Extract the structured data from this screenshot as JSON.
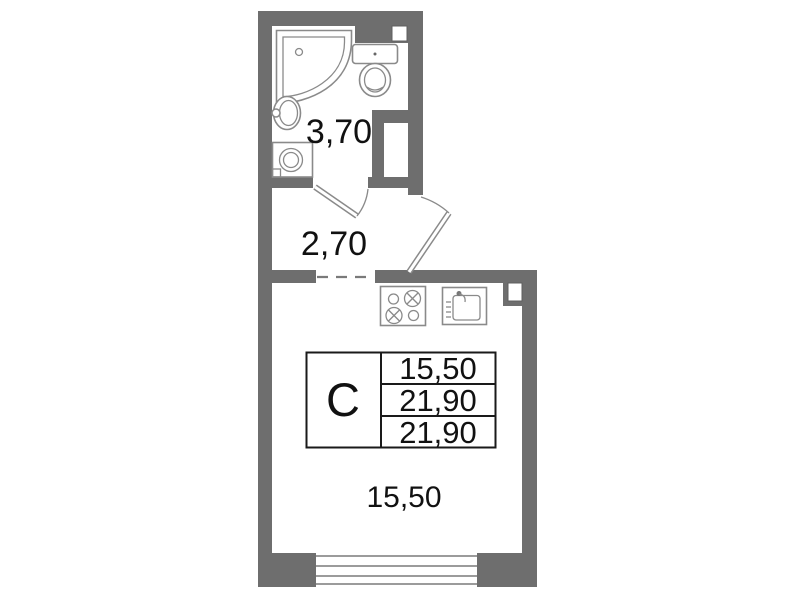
{
  "colors": {
    "wall": "#6e6e6e",
    "fixture_line": "#8a8a8a",
    "text": "#111111",
    "table_line": "#1a1a1a",
    "background": "#ffffff"
  },
  "rooms": {
    "bathroom": {
      "area_label": "3,70"
    },
    "hallway": {
      "area_label": "2,70"
    },
    "main_room": {
      "area_label": "15,50"
    }
  },
  "info_table": {
    "apartment_type": "C",
    "values": [
      "15,50",
      "21,90",
      "21,90"
    ]
  },
  "fixtures": [
    "shower",
    "toilet",
    "sink",
    "washing-machine",
    "stove",
    "kitchen-sink",
    "window",
    "bathroom-door",
    "entrance-door",
    "vent-shaft"
  ]
}
